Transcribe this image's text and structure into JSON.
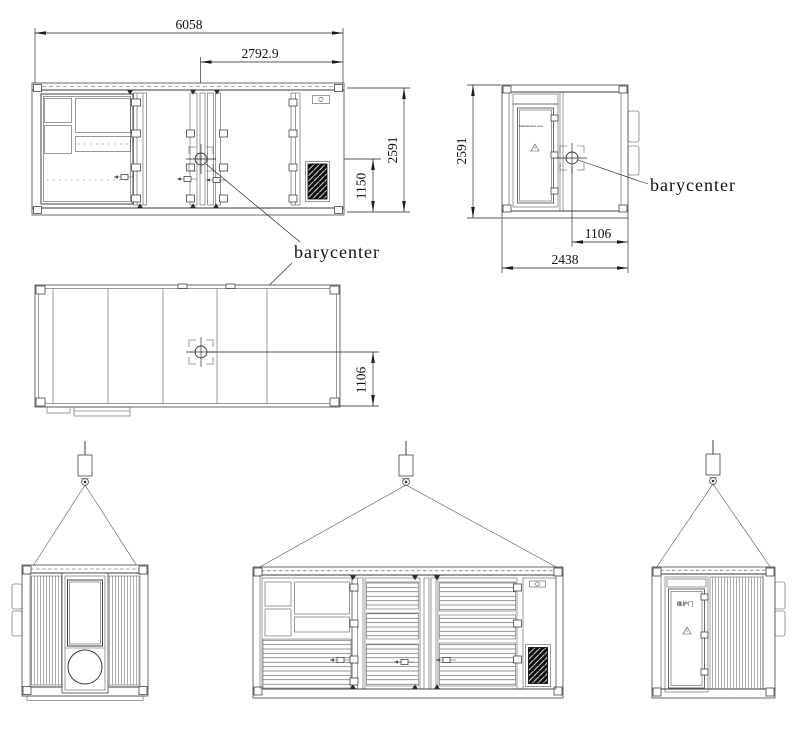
{
  "labels": {
    "barycenter_side": "barycenter",
    "barycenter_end": "barycenter"
  },
  "side_view": {
    "length": "6058",
    "cg_from_right": "2792.9",
    "height": "2591",
    "cg_height": "1150"
  },
  "end_view": {
    "height": "2591",
    "cg_offset": "1106",
    "width": "2438",
    "door_label": "Maintenance door"
  },
  "plan_view": {
    "cg_offset": "1106"
  },
  "lift_end_view": {
    "door_label": "维护门"
  }
}
